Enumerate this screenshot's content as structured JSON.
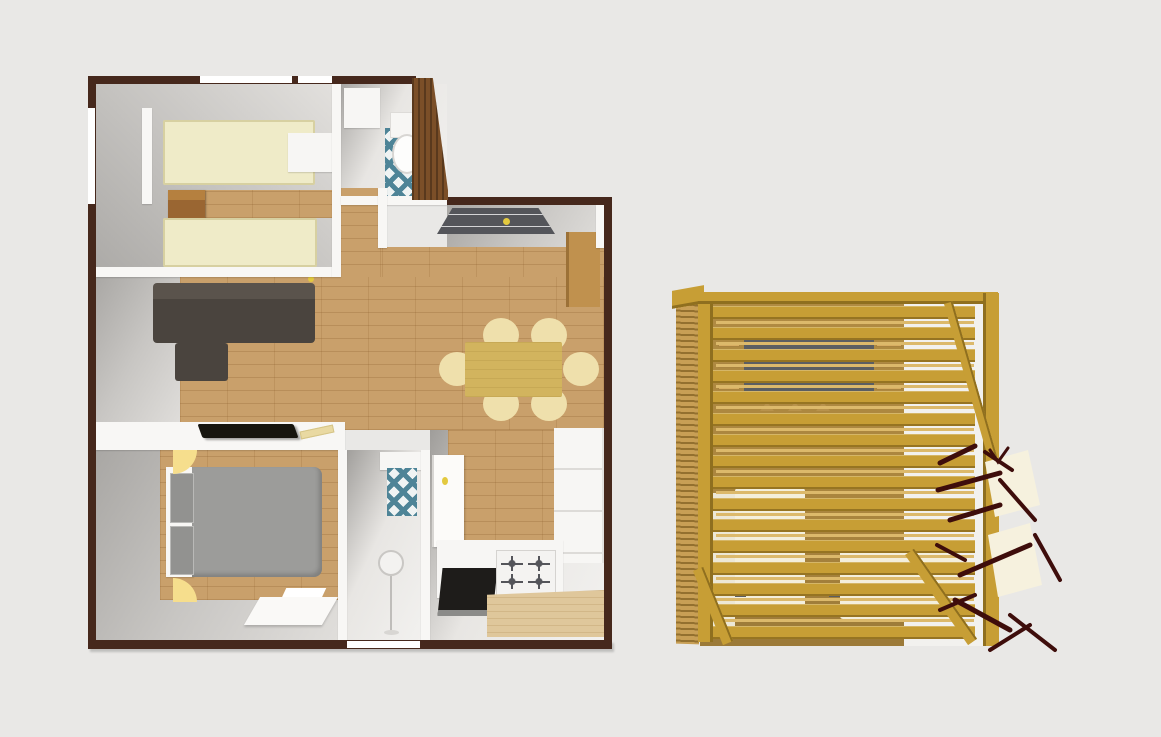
{
  "scene": {
    "description": "3D aerial rendering of a small apartment floor plan next to a slatted wooden pergola with lounge furniture and a bare-branched plant",
    "background_color": "#E9E8E6",
    "visible_text": ""
  },
  "colors": {
    "background": "#E9E8E6",
    "wall": "#46281C",
    "wall-wood": "#7B4F28",
    "white": "#F8F7F5",
    "floor-gray": "#BDBBB8",
    "parquet": "#C9A06B",
    "bed-cream": "#EFEBC8",
    "sofa": "#4A443E",
    "tv-black": "#17150F",
    "table-tan": "#D2B45E",
    "chair-cream": "#EFE0AC",
    "sideboard": "#C0914E",
    "tile-blue": "#4E8497",
    "bed-gray": "#9C9C9A",
    "lamp-yellow": "#F6DE8D",
    "counter-wood": "#DFC79B",
    "oven-black": "#1E1C1A",
    "steel-gray": "#54555A",
    "pergola-gold": "#C79E35",
    "pergola-dark": "#8F6F1F",
    "pergola-light": "#DCB96B",
    "pergola-underlay": "#AA853E",
    "pergola-table-gray": "#5B5E62",
    "cushion-cream": "#F4EFDC",
    "branch-maroon": "#3E0D0B",
    "leaf-cream": "#F6F1DE",
    "accent-yellow": "#E3C93F"
  },
  "house": {
    "name": "apartment-floor-plan",
    "shape": "L-shaped, dark brown exterior walls, notched top-right corner with wooden entrance panel",
    "rooms": [
      {
        "id": "twin-bedroom",
        "position": "top-left",
        "furniture": [
          "single-bed",
          "single-bed",
          "wood-nightstand"
        ]
      },
      {
        "id": "bathroom-top",
        "position": "top-center",
        "furniture": [
          "washbasin",
          "toilet",
          "blue-lattice-tile"
        ]
      },
      {
        "id": "entrance-hall",
        "position": "top-right-wing",
        "furniture": [
          "doormat"
        ]
      },
      {
        "id": "living-dining",
        "position": "center",
        "furniture": [
          "corner-sofa",
          "flat-tv",
          "dining-table",
          "six-round-chairs",
          "sideboard"
        ]
      },
      {
        "id": "double-bedroom",
        "position": "bottom-left",
        "furniture": [
          "double-bed",
          "two-pillows",
          "two-yellow-lamps",
          "white-rug"
        ]
      },
      {
        "id": "bathroom-bottom",
        "position": "bottom-center",
        "furniture": [
          "washbasin",
          "blue-lattice-tile",
          "floor-fan"
        ]
      },
      {
        "id": "kitchen",
        "position": "bottom-right",
        "furniture": [
          "white-door",
          "gas-hob",
          "black-oven",
          "wood-countertop",
          "fridge-cabinet-column"
        ]
      }
    ]
  },
  "pergola": {
    "name": "garden-pergola",
    "slat_count": 16,
    "rail_count": 15,
    "table_bar_count": 3,
    "deco_triangle_count": 3,
    "cushion_count": 2,
    "gray_block_count": 4,
    "description": "golden slatted roof seen from above; gray table, thin rails and cream loungers visible between slats; diagonal corner braces"
  },
  "kitchen": {
    "burner_count": 4
  },
  "dining": {
    "chair_count": 6
  },
  "plant": {
    "name": "bare-branch-plant",
    "leaf_count": 2,
    "branch_color": "#3E0D0B"
  }
}
